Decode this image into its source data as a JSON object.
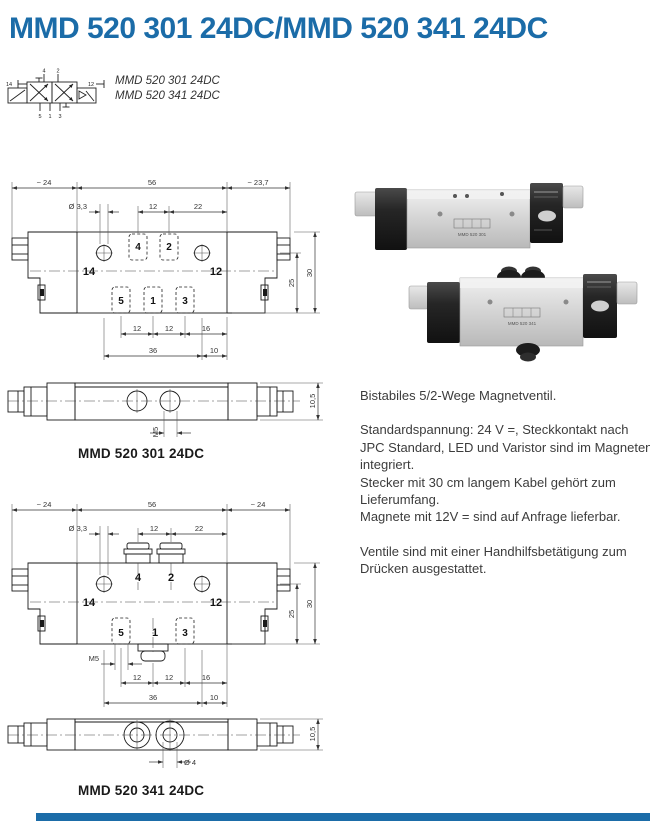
{
  "page": {
    "title": "MMD 520 301 24DC/MMD 520 341 24DC",
    "accent_color": "#1b6ca8"
  },
  "symbol": {
    "variants": [
      "MMD 520 301 24DC",
      "MMD 520 341 24DC"
    ],
    "ports": {
      "p4": "4",
      "p2": "2",
      "p5": "5",
      "p1": "1",
      "p3": "3",
      "p14": "14",
      "p12": "12"
    }
  },
  "drawing_301": {
    "caption": "MMD 520 301 24DC",
    "dim_top_left": "~ 24",
    "dim_top_mid": "56",
    "dim_top_right": "~ 23,7",
    "dim_hole": "Ø 3,3",
    "dim_12a": "12",
    "dim_22": "22",
    "dim_b12a": "12",
    "dim_b12b": "12",
    "dim_b16": "16",
    "dim_b36": "36",
    "dim_b10": "10",
    "dim_r25": "25",
    "dim_r30": "30",
    "ports": {
      "p4": "4",
      "p2": "2",
      "p5": "5",
      "p1": "1",
      "p3": "3",
      "p14": "14",
      "p12": "12"
    },
    "side": {
      "dim_m5": "M5",
      "dim_105": "10,5"
    }
  },
  "drawing_341": {
    "caption": "MMD 520 341 24DC",
    "dim_top_left": "~ 24",
    "dim_top_mid": "56",
    "dim_top_right": "~ 24",
    "dim_hole": "Ø 3,3",
    "dim_12a": "12",
    "dim_22": "22",
    "dim_m5": "M5",
    "dim_b12a": "12",
    "dim_b12b": "12",
    "dim_b16": "16",
    "dim_b36": "36",
    "dim_b10": "10",
    "dim_r25": "25",
    "dim_r30": "30",
    "ports": {
      "p4": "4",
      "p2": "2",
      "p5": "5",
      "p1": "1",
      "p3": "3",
      "p14": "14",
      "p12": "12"
    },
    "bottom": {
      "dim_d4": "Ø 4",
      "dim_105": "10,5"
    }
  },
  "photo": {
    "valve_top_label": "MMD 520 301",
    "valve_bottom_label": "MMD 520 341"
  },
  "description": {
    "p1": "Bistabiles 5/2-Wege Magnetventil.",
    "p2": "Standardspannung: 24 V =, Steckkontakt nach\nJPC Standard, LED und Varistor sind im Magneten\nintegriert.\nStecker mit 30 cm langem Kabel gehört zum\nLieferumfang.\nMagnete mit 12V = sind auf Anfrage lieferbar.",
    "p3": "Ventile sind mit einer Handhilfsbetätigung zum\nDrücken ausgestattet."
  }
}
